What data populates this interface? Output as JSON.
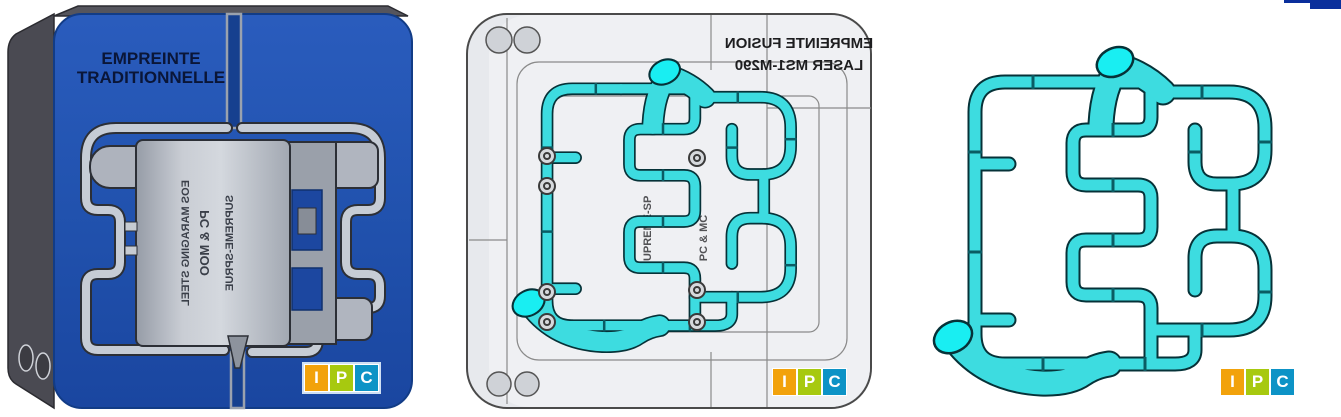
{
  "panel_traditional": {
    "title_line1": "EMPREINTE",
    "title_line2": "TRADITIONNELLE",
    "insert_line1": "EOS MARAGING STEEL",
    "insert_line2": "PC & MOO",
    "insert_line3": "SUPREME-SPRUE",
    "block_color": "#2152ae",
    "side_color": "#4a4a52",
    "groove_color": "#c6ccd5",
    "insert_color": "#b9bec7"
  },
  "panel_laser": {
    "title_line1": "EMPREINTE FUSION",
    "title_line2": "LASER MS1-M290",
    "title_mirrored": "true",
    "insert_text_1": "SUPREME-SP",
    "insert_text_2": "PC & MC",
    "block_color": "#e8eaee",
    "pipe_color": "#3ddce0",
    "cap_color": "#19eef2"
  },
  "panel_channels": {
    "pipe_color": "#3ddce0",
    "cap_color": "#19eef2"
  },
  "logo": {
    "i": "I",
    "p": "P",
    "c": "C",
    "i_bg": "#f2a20b",
    "p_bg": "#a7c90f",
    "c_bg": "#0d93c6"
  },
  "decor": {
    "corner_color": "#0a2f9c"
  }
}
